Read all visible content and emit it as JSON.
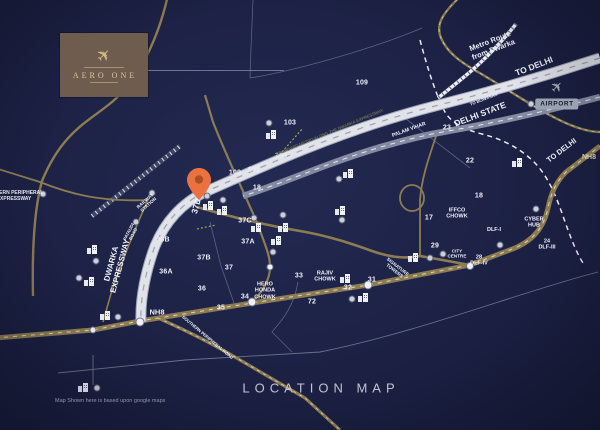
{
  "brand": {
    "name": "AERO ONE"
  },
  "airport": {
    "label": "AIRPORT"
  },
  "footer": {
    "title": "LOCATION MAP",
    "disclaimer": "Map Shown here is based upon google maps"
  },
  "map": {
    "bg": "#1c2144",
    "gold": "#8d7c52",
    "pin_color": "#ec7140",
    "roads": [
      {
        "name": "boundary-1",
        "d": "M253,0 L251,48 L250,78",
        "stroke": "#5c6280",
        "w": 0.8
      },
      {
        "name": "boundary-2",
        "d": "M250,78 C300,70 380,46 422,28",
        "stroke": "#5c6280",
        "w": 0.8
      },
      {
        "name": "boundary-3",
        "d": "M210,222 L221,266 L234,303",
        "stroke": "#5c6280",
        "w": 0.8
      },
      {
        "name": "boundary-4",
        "d": "M298,282 C293,312 276,326 272,332 L292,352",
        "stroke": "#5c6280",
        "w": 0.8
      },
      {
        "name": "boundary-5",
        "d": "M58,373 L185,360 L320,352 C420,332 520,292 598,272",
        "stroke": "#6c7189",
        "w": 0.9
      },
      {
        "name": "boundary-6",
        "d": "M93,355 L93,385",
        "stroke": "#6c7189",
        "w": 0.9
      },
      {
        "name": "boundary-7",
        "d": "M397,112 L470,168",
        "stroke": "#5c6280",
        "w": 0.8
      },
      {
        "name": "delhi-state-border",
        "d": "M420,40 C428,70 436,95 445,112 C452,124 466,130 482,134 C502,139 520,148 534,162 C548,176 556,196 563,216 C570,236 576,252 583,263",
        "stroke": "#e8eaf2",
        "w": 1.5,
        "dash": "5,4"
      },
      {
        "name": "railway-track",
        "d": "M92,216 L180,146",
        "stroke": "#3f4460",
        "w": 5
      },
      {
        "name": "railway-track-ticks",
        "d": "M92,216 L180,146",
        "stroke": "#ccd1e0",
        "w": 4,
        "dash": "1.2,3.8"
      },
      {
        "name": "western-peripheral-expressway",
        "d": "M168,-5 C158,40 138,80 112,102 C88,122 62,132 42,181 C34,210 32,250 33,296",
        "stroke": "#8d7c52",
        "w": 2.4
      },
      {
        "name": "west-link-road",
        "d": "M-5,168 L40,182 C70,194 100,202 148,200",
        "stroke": "#8d7c52",
        "w": 1.8
      },
      {
        "name": "pataudi-road",
        "d": "M148,200 C135,228 122,262 112,290 L103,322",
        "stroke": "#8d7c52",
        "w": 1.6
      },
      {
        "name": "sector-road-north",
        "d": "M205,95 L213,122 C228,160 243,190 258,225 C265,245 270,255 270,267 C270,280 262,292 254,300",
        "stroke": "#8d7c52",
        "w": 2.2
      },
      {
        "name": "cross-road",
        "d": "M197,207 C235,218 270,226 300,231 C330,236 355,245 372,251 C395,259 408,258 420,256 L470,265",
        "stroke": "#8d7c52",
        "w": 2.6
      },
      {
        "name": "interchange-road",
        "d": "M437,133 C430,155 422,175 420,200 L420,256",
        "stroke": "#8d7c52",
        "w": 1.8
      },
      {
        "name": "airport-road",
        "d": "M462,-5 C440,15 436,26 441,38 C447,52 460,62 478,72 C506,88 540,112 568,124 C580,129 592,132 600,132",
        "stroke": "#8d7c52",
        "w": 2.4
      },
      {
        "name": "airport-road-dash",
        "d": "M462,-5 C440,15 436,26 441,38 C447,52 460,62 478,72 C506,88 540,112 568,124 C580,129 592,132 600,132",
        "stroke": "#ded7b2",
        "w": 0.7,
        "dash": "3,4"
      },
      {
        "name": "nh8-highway",
        "d": "M-5,338 L93,330 L140,321 L252,303 L368,285 L470,265 L515,248 C538,238 545,222 548,208 C551,193 556,182 566,172 L600,146",
        "stroke": "#8d7c52",
        "w": 5
      },
      {
        "name": "nh8-highway-dash",
        "d": "M-5,338 L93,330 L140,321 L252,303 L368,285 L470,265 L515,248 C538,238 545,222 548,208 C551,193 556,182 566,172 L600,146",
        "stroke": "#ded7b2",
        "w": 1,
        "dash": "4,5"
      },
      {
        "name": "southern-peripheral-road",
        "d": "M158,318 C185,330 215,345 240,360 L305,398 L340,430",
        "stroke": "#8d7c52",
        "w": 3.2
      },
      {
        "name": "southern-peripheral-road-dash",
        "d": "M158,318 C185,330 215,345 240,360 L305,398 L340,430",
        "stroke": "#ded7b2",
        "w": 0.8,
        "dash": "3,4"
      },
      {
        "name": "old-delhi-road",
        "d": "M600,97 C550,110 500,122 448,131 C408,138 368,150 330,164 C300,175 268,188 243,196",
        "stroke": "#848aa0",
        "w": 6.5
      },
      {
        "name": "old-delhi-road-dash",
        "d": "M600,97 C550,110 500,122 448,131 C408,138 368,150 330,164 C300,175 268,188 243,196",
        "stroke": "#e6e8ef",
        "w": 1,
        "dash": "5,5"
      },
      {
        "name": "dwarka-expressway-casing",
        "d": "M600,58 C545,76 490,92 435,106 C392,117 350,131 305,149 C270,163 232,180 205,192 C182,203 165,222 155,246 C146,270 140,298 141,322",
        "stroke": "#99a2b8",
        "w": 11
      },
      {
        "name": "dwarka-expressway",
        "d": "M600,58 C545,76 490,92 435,106 C392,117 350,131 305,149 C270,163 232,180 205,192 C182,203 165,222 155,246 C146,270 140,298 141,322",
        "stroke": "#e2e3e9",
        "w": 9
      },
      {
        "name": "dwarka-expressway-dash",
        "d": "M600,58 C545,76 490,92 435,106 C392,117 350,131 305,149 C270,163 232,180 205,192 C182,203 165,222 155,246 C146,270 140,298 141,322",
        "stroke": "#9aa0b5",
        "w": 1.2,
        "dash": "6,7"
      },
      {
        "name": "metro-line",
        "d": "M516,24 C500,44 484,60 470,72 C458,82 448,90 438,98",
        "stroke": "#eef0f5",
        "w": 3.5
      },
      {
        "name": "metro-line-ticks",
        "d": "M516,24 C500,44 484,60 470,72 C458,82 448,90 438,98",
        "stroke": "#676d8e",
        "w": 4.5,
        "dash": "1.2,3.6"
      },
      {
        "name": "site-boundary-green-1",
        "d": "M282,152 L303,128",
        "stroke": "#93a94e",
        "w": 1.2,
        "dash": "2,2"
      },
      {
        "name": "site-boundary-green-2",
        "d": "M197,229 L216,225",
        "stroke": "#93a94e",
        "w": 1.2,
        "dash": "2,2"
      }
    ],
    "interchange_loop": {
      "cx": 412,
      "cy": 198,
      "rx": 12,
      "ry": 13,
      "stroke": "#8d7c52",
      "w": 1.8
    },
    "sectors": [
      {
        "t": "109",
        "x": 362,
        "y": 83
      },
      {
        "t": "103",
        "x": 290,
        "y": 123
      },
      {
        "t": "104",
        "x": 281,
        "y": 156
      },
      {
        "t": "100",
        "x": 235,
        "y": 173
      },
      {
        "t": "101",
        "x": 254,
        "y": 170
      },
      {
        "t": "18",
        "x": 257,
        "y": 188
      },
      {
        "t": "23",
        "x": 447,
        "y": 128
      },
      {
        "t": "22",
        "x": 470,
        "y": 161
      },
      {
        "t": "18",
        "x": 479,
        "y": 196
      },
      {
        "t": "17",
        "x": 429,
        "y": 218
      },
      {
        "t": "29",
        "x": 435,
        "y": 246
      },
      {
        "t": "36B",
        "x": 163,
        "y": 240
      },
      {
        "t": "37C",
        "x": 245,
        "y": 221
      },
      {
        "t": "37A",
        "x": 248,
        "y": 242
      },
      {
        "t": "37B",
        "x": 204,
        "y": 258
      },
      {
        "t": "37",
        "x": 229,
        "y": 268
      },
      {
        "t": "36A",
        "x": 166,
        "y": 272
      },
      {
        "t": "36",
        "x": 202,
        "y": 289
      },
      {
        "t": "35",
        "x": 221,
        "y": 308
      },
      {
        "t": "34",
        "x": 245,
        "y": 297
      },
      {
        "t": "33",
        "x": 299,
        "y": 276
      },
      {
        "t": "72",
        "x": 312,
        "y": 302
      },
      {
        "t": "31",
        "x": 372,
        "y": 280
      },
      {
        "t": "32",
        "x": 348,
        "y": 288
      }
    ],
    "labels": [
      {
        "id": "metro-route-note",
        "lines": [
          "Metro Route",
          "from Dwarka"
        ],
        "x": 492,
        "y": 46,
        "rot": -21,
        "size": 7.5,
        "weight": 700
      },
      {
        "id": "to-delhi-top",
        "lines": [
          "TO DELHI"
        ],
        "x": 534,
        "y": 66,
        "rot": -21,
        "size": 8.5,
        "weight": 700
      },
      {
        "id": "to-bijwasan",
        "lines": [
          "TO BIJWASAN"
        ],
        "x": 484,
        "y": 100,
        "rot": -21,
        "size": 4.2,
        "weight": 600
      },
      {
        "id": "delhi-state",
        "lines": [
          "DELHI STATE"
        ],
        "x": 480,
        "y": 114,
        "rot": -21,
        "size": 8.5,
        "weight": 700
      },
      {
        "id": "nh8-right",
        "lines": [
          "NH8"
        ],
        "x": 589,
        "y": 158,
        "rot": 0,
        "size": 7,
        "weight": 700,
        "color": "#d9d3b4"
      },
      {
        "id": "to-delhi-right",
        "lines": [
          "TO DELHI"
        ],
        "x": 562,
        "y": 151,
        "rot": -37,
        "size": 7.5,
        "weight": 700
      },
      {
        "id": "palam-vihar",
        "lines": [
          "PALAM VIHAR"
        ],
        "x": 409,
        "y": 130,
        "rot": -20,
        "size": 5.2,
        "weight": 600
      },
      {
        "id": "iffco-chowk",
        "lines": [
          "IFFCO",
          "CHOWK"
        ],
        "x": 457,
        "y": 214,
        "rot": 0,
        "size": 5.5,
        "weight": 700
      },
      {
        "id": "cyber-hub",
        "lines": [
          "CYBER",
          "HUB"
        ],
        "x": 534,
        "y": 223,
        "rot": 0,
        "size": 5.5,
        "weight": 700
      },
      {
        "id": "dlf-1",
        "lines": [
          "DLF-I"
        ],
        "x": 494,
        "y": 230,
        "rot": 0,
        "size": 5.5,
        "weight": 700
      },
      {
        "id": "dlf-3",
        "lines": [
          "24",
          "DLF-III"
        ],
        "x": 547,
        "y": 245,
        "rot": 0,
        "size": 5.5,
        "weight": 700
      },
      {
        "id": "dlf-4",
        "lines": [
          "28",
          "DLF-IV"
        ],
        "x": 479,
        "y": 261,
        "rot": 0,
        "size": 5.5,
        "weight": 700
      },
      {
        "id": "city-centre",
        "lines": [
          "CITY",
          "CENTRE"
        ],
        "x": 457,
        "y": 254,
        "rot": 0,
        "size": 4.6,
        "weight": 700
      },
      {
        "id": "rajiv-chowk",
        "lines": [
          "RAJIV",
          "CHOWK"
        ],
        "x": 325,
        "y": 277,
        "rot": 0,
        "size": 5.5,
        "weight": 700
      },
      {
        "id": "hero-honda-chowk",
        "lines": [
          "HERO",
          "HONDA",
          "CHOWK"
        ],
        "x": 265,
        "y": 291,
        "rot": 0,
        "size": 5.5,
        "weight": 700
      },
      {
        "id": "signature-towers",
        "lines": [
          "SIGNATURE",
          "TOWERS"
        ],
        "x": 396,
        "y": 269,
        "rot": 38,
        "size": 4.6,
        "weight": 700
      },
      {
        "id": "dwarka-expressway-name",
        "lines": [
          "DWARKA",
          "EXPRESSWAY"
        ],
        "x": 116,
        "y": 265,
        "rot": -75,
        "size": 8,
        "weight": 700
      },
      {
        "id": "sector-37d",
        "lines": [
          "37D"
        ],
        "x": 196,
        "y": 206,
        "rot": -75,
        "size": 8.5,
        "weight": 700
      },
      {
        "id": "nh8-left",
        "lines": [
          "NH8"
        ],
        "x": 157,
        "y": 313,
        "rot": 0,
        "size": 7.5,
        "weight": 700
      },
      {
        "id": "southern-peripheral-road-name",
        "lines": [
          "SOUTHERN PERIPHERAL ROAD"
        ],
        "x": 207,
        "y": 338,
        "rot": 40,
        "size": 4.2,
        "weight": 600
      },
      {
        "id": "western-peripheral-expressway-name",
        "lines": [
          "WESTERN PERIPHERAL",
          "EXPRESSWAY"
        ],
        "x": 14,
        "y": 197,
        "rot": 0,
        "size": 5,
        "weight": 600
      },
      {
        "id": "railway-station",
        "lines": [
          "RAILWAY",
          "STATION"
        ],
        "x": 147,
        "y": 203,
        "rot": -42,
        "size": 4.6,
        "weight": 600
      },
      {
        "id": "pataudi-road-name",
        "lines": [
          "PATAUDI",
          "ROAD"
        ],
        "x": 131,
        "y": 233,
        "rot": -63,
        "size": 4.4,
        "weight": 600
      },
      {
        "id": "metro-corridor-note",
        "lines": [
          "PROPOSED METRO ALONG THE DWARKA EXPRESSWAY"
        ],
        "x": 330,
        "y": 133,
        "rot": -22.5,
        "size": 4.2,
        "weight": 700,
        "color": "#70714a"
      }
    ],
    "circles": [
      [
        43,
        194
      ],
      [
        152,
        193
      ],
      [
        136,
        222
      ],
      [
        96,
        261
      ],
      [
        79,
        278
      ],
      [
        118,
        317
      ],
      [
        97,
        388
      ],
      [
        207,
        196
      ],
      [
        223,
        200
      ],
      [
        254,
        218
      ],
      [
        273,
        252
      ],
      [
        283,
        215
      ],
      [
        339,
        179
      ],
      [
        342,
        220
      ],
      [
        536,
        209
      ],
      [
        500,
        245
      ],
      [
        443,
        254
      ],
      [
        430,
        258
      ],
      [
        531,
        104
      ],
      [
        352,
        299
      ],
      [
        269,
        123
      ]
    ],
    "buildings": [
      [
        271,
        135
      ],
      [
        92,
        250
      ],
      [
        89,
        282
      ],
      [
        105,
        316
      ],
      [
        83,
        388
      ],
      [
        208,
        206
      ],
      [
        222,
        211
      ],
      [
        256,
        228
      ],
      [
        283,
        228
      ],
      [
        276,
        241
      ],
      [
        348,
        174
      ],
      [
        340,
        211
      ],
      [
        345,
        279
      ],
      [
        363,
        298
      ],
      [
        517,
        163
      ],
      [
        413,
        258
      ]
    ],
    "roundabouts": [
      [
        140,
        322,
        9
      ],
      [
        93,
        330,
        7
      ],
      [
        252,
        302,
        9
      ],
      [
        368,
        285,
        9
      ],
      [
        470,
        266,
        8
      ],
      [
        270,
        267,
        7
      ]
    ],
    "pin": {
      "x": 199,
      "y": 200
    }
  }
}
